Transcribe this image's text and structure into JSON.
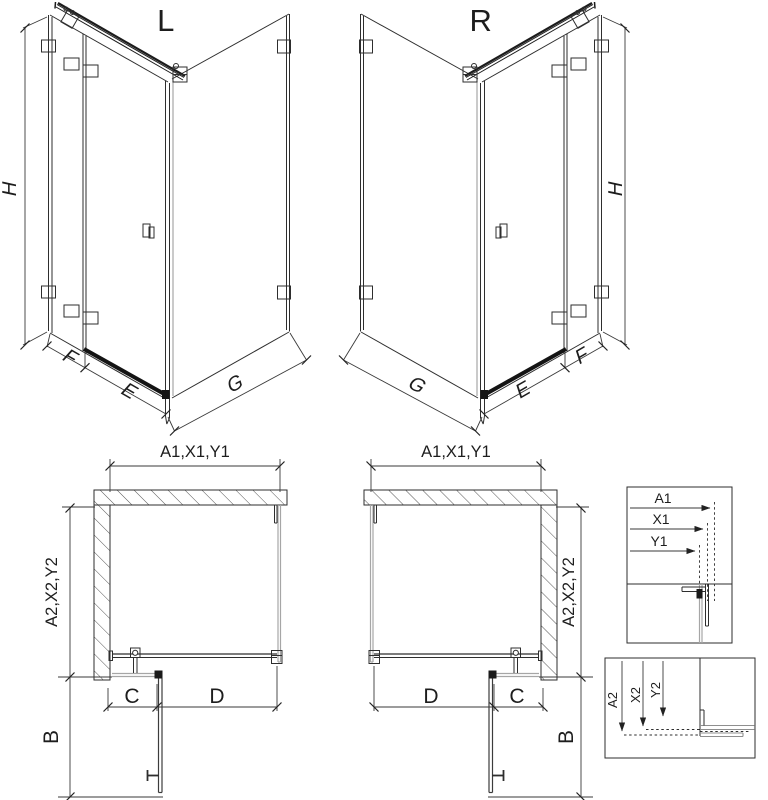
{
  "page": {
    "title": "Shower corner enclosure technical drawing, left (L) and right (R) versions"
  },
  "colors": {
    "line": "#2e2e2e",
    "glass_edge": "#a6a6a6",
    "dimension_line": "#3a3a3a",
    "hatch": "#565656",
    "solid_black": "#1a1a1a",
    "background": "#ffffff"
  },
  "iso_left": {
    "label": "L",
    "height_dim": "H",
    "fixed_panel_dim": "F",
    "door_dim": "E",
    "side_panel_dim": "G"
  },
  "iso_right": {
    "label": "R",
    "height_dim": "H",
    "fixed_panel_dim": "F",
    "door_dim": "E",
    "side_panel_dim": "G"
  },
  "plan_left": {
    "width_dim": "A1,X1,Y1",
    "depth_dim": "A2,X2,Y2",
    "wall_segment_dim": "C",
    "opening_dim": "D",
    "door_swing_dim": "B"
  },
  "plan_right": {
    "width_dim": "A1,X1,Y1",
    "depth_dim": "A2,X2,Y2",
    "wall_segment_dim": "C",
    "opening_dim": "D",
    "door_swing_dim": "B"
  },
  "detail_width_box": {
    "dims": [
      "A1",
      "X1",
      "Y1"
    ]
  },
  "detail_depth_box": {
    "dims": [
      "A2",
      "X2",
      "Y2"
    ]
  }
}
